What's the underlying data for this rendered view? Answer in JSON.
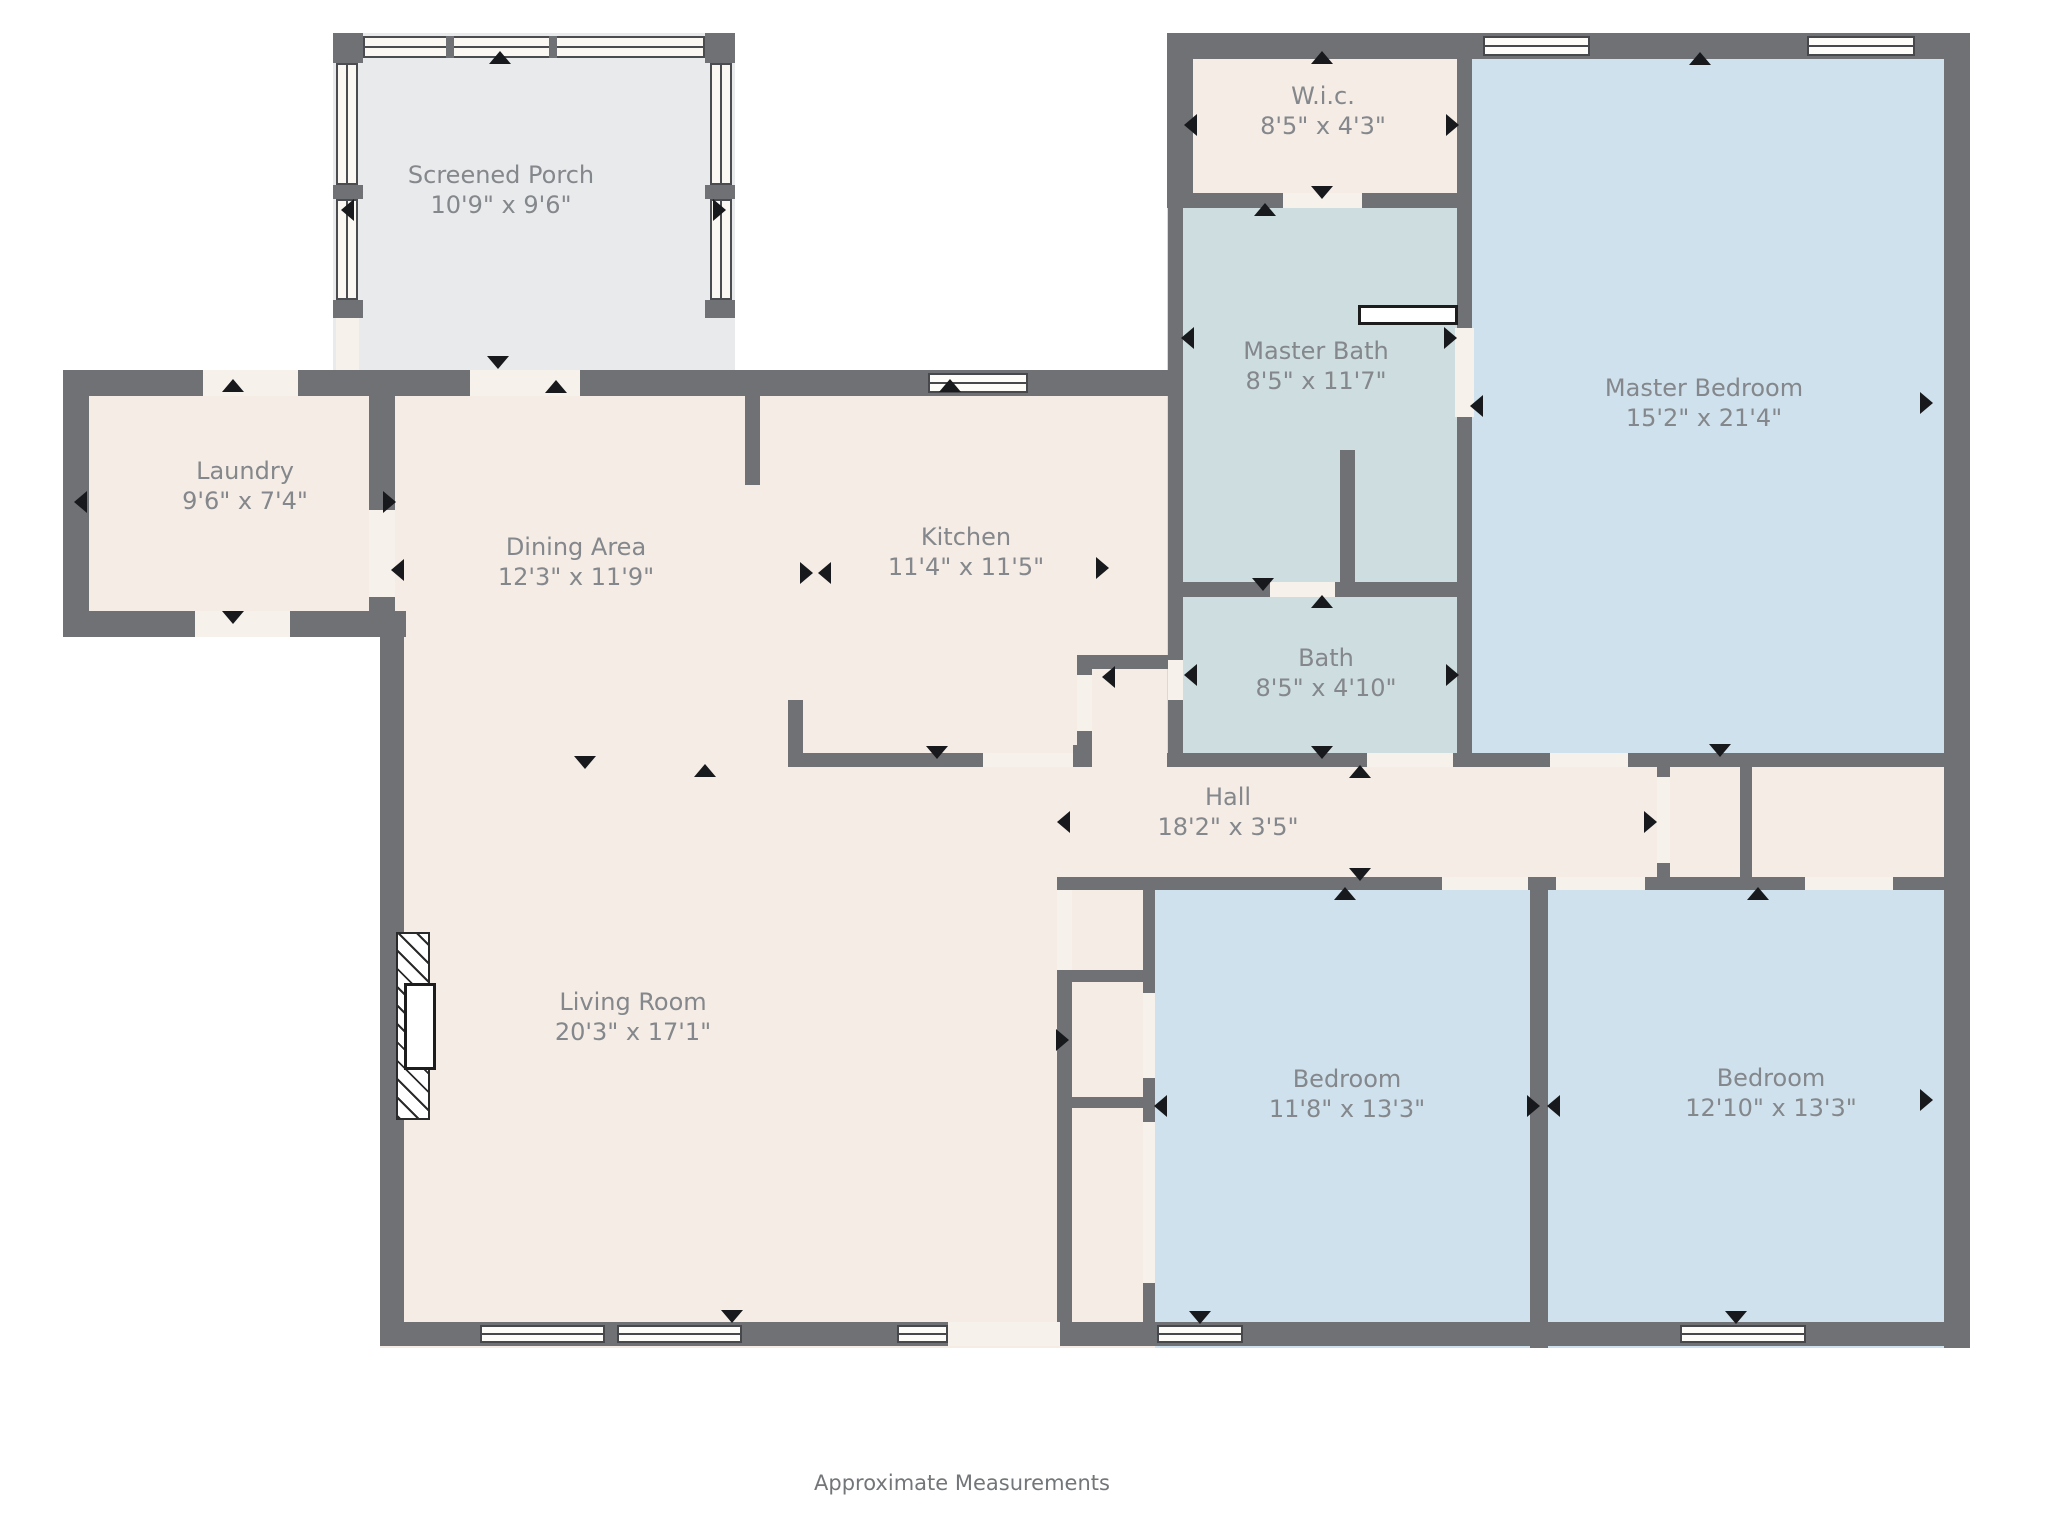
{
  "footer": {
    "note": "Approximate Measurements"
  },
  "colors": {
    "wall": "#6f7174",
    "cream": "#f4ece5",
    "blue": "#cfe1ec",
    "bathfill": "#cddde0",
    "porch": "#e8eaeb",
    "door_gap": "#f6f1ea",
    "label_text": "#84878b",
    "arrow": "#17191c",
    "window_frame": "#46484b"
  },
  "canvas": {
    "width": 2048,
    "height": 1536
  },
  "rooms": [
    {
      "id": "screened-porch",
      "name": "Screened Porch",
      "dims": "10'9\" x 9'6\"",
      "cx": 501,
      "cy": 190
    },
    {
      "id": "laundry",
      "name": "Laundry",
      "dims": "9'6\" x 7'4\"",
      "cx": 245,
      "cy": 486
    },
    {
      "id": "dining-area",
      "name": "Dining Area",
      "dims": "12'3\" x 11'9\"",
      "cx": 576,
      "cy": 562
    },
    {
      "id": "kitchen",
      "name": "Kitchen",
      "dims": "11'4\" x 11'5\"",
      "cx": 966,
      "cy": 552
    },
    {
      "id": "wic",
      "name": "W.i.c.",
      "dims": "8'5\" x 4'3\"",
      "cx": 1323,
      "cy": 111
    },
    {
      "id": "master-bath",
      "name": "Master Bath",
      "dims": "8'5\" x 11'7\"",
      "cx": 1316,
      "cy": 366
    },
    {
      "id": "master-bedroom",
      "name": "Master Bedroom",
      "dims": "15'2\" x 21'4\"",
      "cx": 1704,
      "cy": 403
    },
    {
      "id": "bath",
      "name": "Bath",
      "dims": "8'5\" x 4'10\"",
      "cx": 1326,
      "cy": 673
    },
    {
      "id": "hall",
      "name": "Hall",
      "dims": "18'2\" x 3'5\"",
      "cx": 1228,
      "cy": 812
    },
    {
      "id": "living-room",
      "name": "Living Room",
      "dims": "20'3\" x 17'1\"",
      "cx": 633,
      "cy": 1017
    },
    {
      "id": "bedroom-1",
      "name": "Bedroom",
      "dims": "11'8\" x 13'3\"",
      "cx": 1347,
      "cy": 1094
    },
    {
      "id": "bedroom-2",
      "name": "Bedroom",
      "dims": "12'10\" x 13'3\"",
      "cx": 1771,
      "cy": 1093
    }
  ],
  "fills": [
    {
      "color": "porch",
      "rect": [
        333,
        33,
        402,
        345
      ]
    },
    {
      "color": "cream",
      "rect": [
        380,
        396,
        803,
        952
      ]
    },
    {
      "color": "cream",
      "rect": [
        63,
        370,
        332,
        267
      ]
    },
    {
      "color": "cream",
      "rect": [
        1167,
        33,
        305,
        175
      ]
    },
    {
      "color": "bathfill",
      "rect": [
        1167,
        193,
        305,
        404
      ]
    },
    {
      "color": "bathfill",
      "rect": [
        1167,
        580,
        305,
        187
      ]
    },
    {
      "color": "blue",
      "rect": [
        1460,
        33,
        510,
        720
      ]
    },
    {
      "color": "cream",
      "rect": [
        1057,
        753,
        887,
        137
      ]
    },
    {
      "color": "cream",
      "rect": [
        1057,
        890,
        98,
        433
      ]
    },
    {
      "color": "blue",
      "rect": [
        1155,
        890,
        375,
        458
      ]
    },
    {
      "color": "blue",
      "rect": [
        1548,
        890,
        396,
        458
      ]
    }
  ],
  "walls": [
    [
      1167,
      33,
      803,
      26
    ],
    [
      1944,
      33,
      26,
      1315
    ],
    [
      380,
      1322,
      1590,
      24
    ],
    [
      380,
      611,
      24,
      735
    ],
    [
      63,
      370,
      26,
      267
    ],
    [
      63,
      370,
      332,
      26
    ],
    [
      63,
      611,
      343,
      26
    ],
    [
      1167,
      33,
      26,
      175
    ],
    [
      333,
      370,
      850,
      26
    ],
    [
      369,
      396,
      26,
      114
    ],
    [
      369,
      597,
      26,
      14
    ],
    [
      745,
      396,
      15,
      89
    ],
    [
      788,
      700,
      15,
      67
    ],
    [
      788,
      753,
      195,
      14
    ],
    [
      1073,
      745,
      15,
      22
    ],
    [
      1077,
      655,
      15,
      20
    ],
    [
      1077,
      731,
      15,
      36
    ],
    [
      1092,
      655,
      76,
      14
    ],
    [
      1168,
      208,
      15,
      372
    ],
    [
      1168,
      580,
      15,
      80
    ],
    [
      1168,
      700,
      15,
      67
    ],
    [
      1167,
      193,
      116,
      15
    ],
    [
      1362,
      193,
      110,
      15
    ],
    [
      1457,
      59,
      15,
      134
    ],
    [
      1457,
      193,
      15,
      135
    ],
    [
      1457,
      417,
      15,
      163
    ],
    [
      1457,
      580,
      15,
      187
    ],
    [
      1340,
      450,
      15,
      132
    ],
    [
      1183,
      582,
      87,
      15
    ],
    [
      1335,
      582,
      122,
      15
    ],
    [
      1167,
      753,
      200,
      14
    ],
    [
      1453,
      753,
      19,
      14
    ],
    [
      1472,
      753,
      78,
      14
    ],
    [
      1628,
      753,
      316,
      14
    ],
    [
      1657,
      767,
      13,
      10
    ],
    [
      1657,
      863,
      13,
      14
    ],
    [
      1740,
      753,
      12,
      137
    ],
    [
      1057,
      877,
      385,
      13
    ],
    [
      1528,
      877,
      28,
      13
    ],
    [
      1645,
      877,
      160,
      13
    ],
    [
      1893,
      877,
      51,
      13
    ],
    [
      1530,
      890,
      18,
      458
    ],
    [
      1057,
      970,
      15,
      353
    ],
    [
      1143,
      890,
      12,
      103
    ],
    [
      1143,
      1078,
      12,
      44
    ],
    [
      1143,
      1283,
      12,
      40
    ],
    [
      1057,
      970,
      98,
      12
    ],
    [
      1057,
      1097,
      98,
      11
    ]
  ],
  "door_gaps": [
    [
      203,
      370,
      95,
      26
    ],
    [
      195,
      611,
      95,
      26
    ],
    [
      369,
      510,
      26,
      87
    ],
    [
      470,
      370,
      110,
      26
    ],
    [
      983,
      753,
      90,
      14
    ],
    [
      1077,
      675,
      15,
      56
    ],
    [
      1168,
      660,
      15,
      40
    ],
    [
      1283,
      193,
      79,
      15
    ],
    [
      1455,
      328,
      19,
      89
    ],
    [
      1270,
      582,
      65,
      15
    ],
    [
      1367,
      753,
      86,
      14
    ],
    [
      1550,
      753,
      78,
      14
    ],
    [
      1657,
      777,
      13,
      86
    ],
    [
      1442,
      877,
      86,
      13
    ],
    [
      1556,
      877,
      89,
      13
    ],
    [
      1805,
      877,
      88,
      13
    ],
    [
      948,
      1322,
      112,
      24
    ],
    [
      1057,
      890,
      15,
      80
    ],
    [
      1143,
      993,
      12,
      85
    ],
    [
      1143,
      1122,
      12,
      161
    ],
    [
      336,
      318,
      23,
      52
    ]
  ],
  "windows": [
    [
      1483,
      36,
      107,
      20
    ],
    [
      1807,
      36,
      108,
      20
    ],
    [
      928,
      373,
      100,
      20
    ],
    [
      480,
      1325,
      125,
      18
    ],
    [
      617,
      1325,
      125,
      18
    ],
    [
      897,
      1325,
      51,
      18
    ],
    [
      1157,
      1325,
      86,
      18
    ],
    [
      1680,
      1325,
      126,
      18
    ]
  ],
  "porch": {
    "screens": [
      [
        363,
        36,
        342,
        22
      ],
      [
        336,
        63,
        22,
        122
      ],
      [
        336,
        199,
        22,
        101
      ],
      [
        710,
        63,
        22,
        122
      ],
      [
        710,
        199,
        22,
        101
      ]
    ],
    "posts": [
      [
        333,
        33,
        30,
        30
      ],
      [
        705,
        33,
        30,
        30
      ],
      [
        333,
        185,
        30,
        14
      ],
      [
        705,
        185,
        30,
        14
      ],
      [
        333,
        300,
        30,
        18
      ],
      [
        705,
        300,
        30,
        18
      ],
      [
        446,
        36,
        8,
        22
      ],
      [
        549,
        36,
        8,
        22
      ]
    ]
  },
  "fireplace": {
    "hatch": [
      396,
      932,
      34,
      188
    ],
    "firebox": [
      404,
      983,
      32,
      87
    ]
  },
  "counter": [
    1358,
    305,
    100,
    20
  ],
  "arrows": [
    [
      500,
      57,
      "up"
    ],
    [
      347,
      210,
      "left"
    ],
    [
      719,
      210,
      "right"
    ],
    [
      498,
      362,
      "down"
    ],
    [
      556,
      386,
      "up"
    ],
    [
      233,
      385,
      "up"
    ],
    [
      233,
      617,
      "down"
    ],
    [
      80,
      502,
      "left"
    ],
    [
      389,
      502,
      "right"
    ],
    [
      397,
      570,
      "left"
    ],
    [
      585,
      762,
      "down"
    ],
    [
      705,
      770,
      "up"
    ],
    [
      806,
      573,
      "right"
    ],
    [
      824,
      573,
      "left"
    ],
    [
      950,
      385,
      "up"
    ],
    [
      937,
      752,
      "down"
    ],
    [
      1102,
      568,
      "right"
    ],
    [
      1108,
      677,
      "left"
    ],
    [
      1190,
      675,
      "left"
    ],
    [
      1452,
      675,
      "right"
    ],
    [
      1263,
      584,
      "down"
    ],
    [
      1322,
      601,
      "up"
    ],
    [
      1322,
      752,
      "down"
    ],
    [
      1360,
      771,
      "up"
    ],
    [
      1322,
      57,
      "up"
    ],
    [
      1190,
      125,
      "left"
    ],
    [
      1452,
      125,
      "right"
    ],
    [
      1322,
      192,
      "down"
    ],
    [
      1265,
      209,
      "up"
    ],
    [
      1187,
      338,
      "left"
    ],
    [
      1450,
      338,
      "right"
    ],
    [
      1476,
      406,
      "left"
    ],
    [
      1700,
      58,
      "up"
    ],
    [
      1926,
      403,
      "right"
    ],
    [
      1720,
      750,
      "down"
    ],
    [
      1063,
      822,
      "left"
    ],
    [
      1650,
      822,
      "right"
    ],
    [
      1360,
      874,
      "down"
    ],
    [
      1345,
      893,
      "up"
    ],
    [
      1062,
      1040,
      "right"
    ],
    [
      1160,
      1106,
      "left"
    ],
    [
      1533,
      1106,
      "right"
    ],
    [
      1553,
      1106,
      "left"
    ],
    [
      1200,
      1317,
      "down"
    ],
    [
      1926,
      1100,
      "right"
    ],
    [
      1758,
      893,
      "up"
    ],
    [
      1736,
      1317,
      "down"
    ],
    [
      732,
      1316,
      "down"
    ]
  ],
  "footer_pos": {
    "cx": 962,
    "cy": 1483
  }
}
